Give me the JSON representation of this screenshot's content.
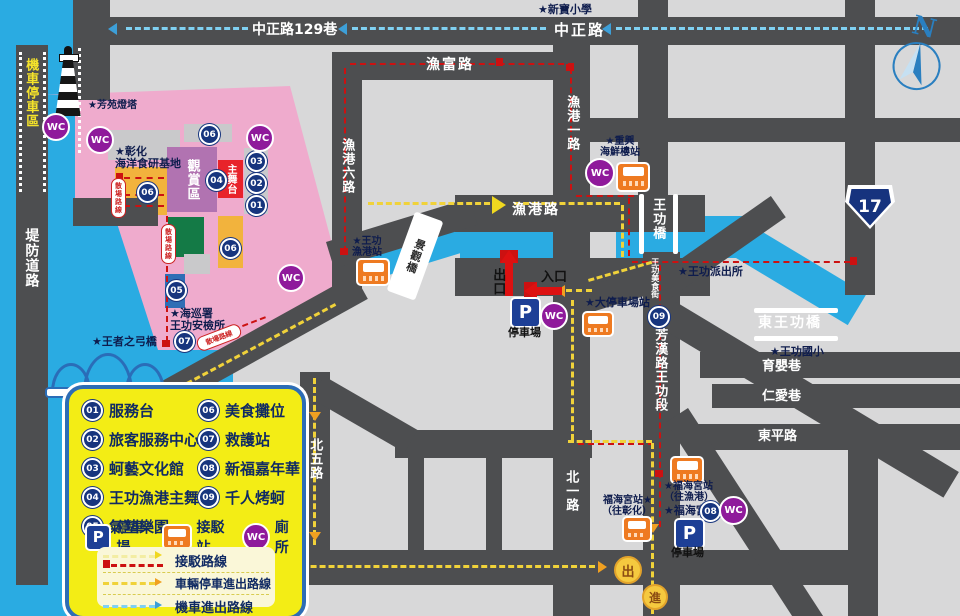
{
  "colors": {
    "water": "#2aabe2",
    "road": "#4d4e50",
    "land": "#d8d8d9",
    "venue_pink": "#efabcd",
    "legend_yellow": "#f3ed15",
    "badge_navy": "#17357e",
    "wc_purple": "#8f1a9b",
    "bus_orange": "#ee7a21",
    "stage_red": "#e8232a",
    "viewing_purple": "#b173b1",
    "route_shuttle_red": "#cc1111",
    "route_vehicle_yellow": "#f0d23a",
    "route_moto_blue": "#7fd0f2"
  },
  "compass": {
    "n": "N"
  },
  "highway": {
    "num": "17"
  },
  "roads": {
    "zhongzheng129": "中正路129巷",
    "zhongzheng": "中正路",
    "yufu": "漁富路",
    "yugang6": "漁港六路",
    "yugang1": "漁港一路",
    "yugang": "漁港路",
    "beiwu": "北五路",
    "beiyi": "北一路",
    "difang": "堤防道路",
    "fanghan": "芳漢路王功段",
    "meishijie": "王功美食街",
    "yuying": "育嬰巷",
    "renai": "仁愛巷",
    "dongping": "東平路",
    "moto_zone": "機車停車區"
  },
  "bridges": {
    "wanggong": "王功橋",
    "dong_wanggong": "東王功橋",
    "jingguan": "景觀橋",
    "archer": "★王者之弓橋"
  },
  "places": {
    "xinbao": "★新寶小學",
    "lighthouse": "★芳苑燈塔",
    "changhua1": "★彰化",
    "changhua2": "海洋食研基地",
    "viewing": "觀賞區",
    "stage": "主舞台",
    "police": "★王功派出所",
    "elem": "★王功國小",
    "coastguard1": "★海巡署",
    "coastguard2": "王功安檢所",
    "fuhai": "★福海宮"
  },
  "stations": {
    "yg1": "★王功",
    "yg2": "漁港站",
    "zx1": "★重興",
    "zx2": "海鮮樓站",
    "big_lot": "★大停車場站",
    "fh_port1": "★福海宮站",
    "fh_port2": "（往漁港）",
    "fh_ch1": "福海宮站★",
    "fh_ch2": "（往彰化）"
  },
  "gates": {
    "exit": "出口",
    "entry": "入口",
    "out": "出",
    "enter": "進"
  },
  "misc": {
    "parking": "停車場",
    "dispersal": "散場路線"
  },
  "badges": {
    "b01": "01",
    "b02": "02",
    "b03": "03",
    "b04": "04",
    "b05": "05",
    "b06": "06",
    "b07": "07",
    "b08": "08",
    "b09": "09",
    "wc": "WC",
    "p": "P"
  },
  "legend": {
    "items": [
      {
        "num": "01",
        "label": "服務台"
      },
      {
        "num": "02",
        "label": "旅客服務中心"
      },
      {
        "num": "03",
        "label": "蚵藝文化館"
      },
      {
        "num": "04",
        "label": "王功漁港主舞台"
      },
      {
        "num": "05",
        "label": "氣墊樂園"
      },
      {
        "num": "06",
        "label": "美食攤位"
      },
      {
        "num": "07",
        "label": "救護站"
      },
      {
        "num": "08",
        "label": "新福嘉年華"
      },
      {
        "num": "09",
        "label": "千人烤蚵"
      }
    ],
    "symbols": {
      "parking": "停車場",
      "shuttle": "接駁站",
      "toilet": "廁所"
    },
    "routes": {
      "shuttle": "接駁路線",
      "vehicle": "車輛停車進出路線",
      "motorcycle": "機車進出路線"
    }
  }
}
